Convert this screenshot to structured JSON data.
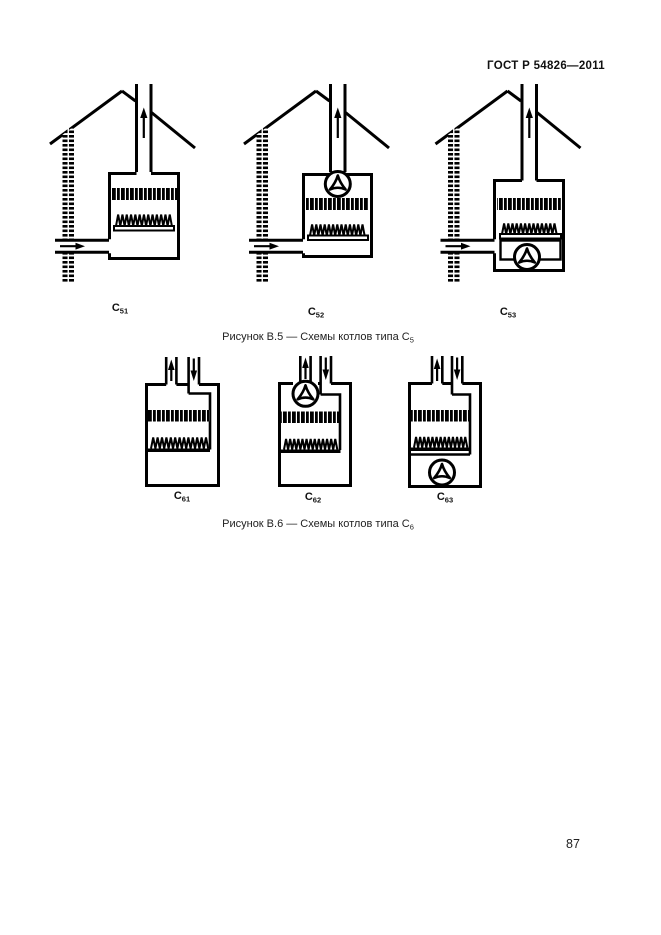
{
  "document": {
    "header": "ГОСТ Р 54826—2011",
    "page_number": "87"
  },
  "figure_b5": {
    "caption_text": "Рисунок В.5 — Схемы котлов типа С",
    "caption_sub": "5",
    "labels": [
      {
        "base": "C",
        "sub": "51"
      },
      {
        "base": "C",
        "sub": "52"
      },
      {
        "base": "C",
        "sub": "53"
      }
    ]
  },
  "figure_b6": {
    "caption_text": "Рисунок В.6 — Схемы котлов типа С",
    "caption_sub": "6",
    "labels": [
      {
        "base": "C",
        "sub": "61"
      },
      {
        "base": "C",
        "sub": "62"
      },
      {
        "base": "C",
        "sub": "63"
      }
    ]
  },
  "icons": {
    "fan": "fan-impeller",
    "up_arrow": "flue-gas-up-arrow",
    "down_arrow": "air-intake-down-arrow",
    "right_arrow": "air-intake-right-arrow"
  },
  "colors": {
    "ink": "#000000",
    "paper": "#ffffff"
  }
}
